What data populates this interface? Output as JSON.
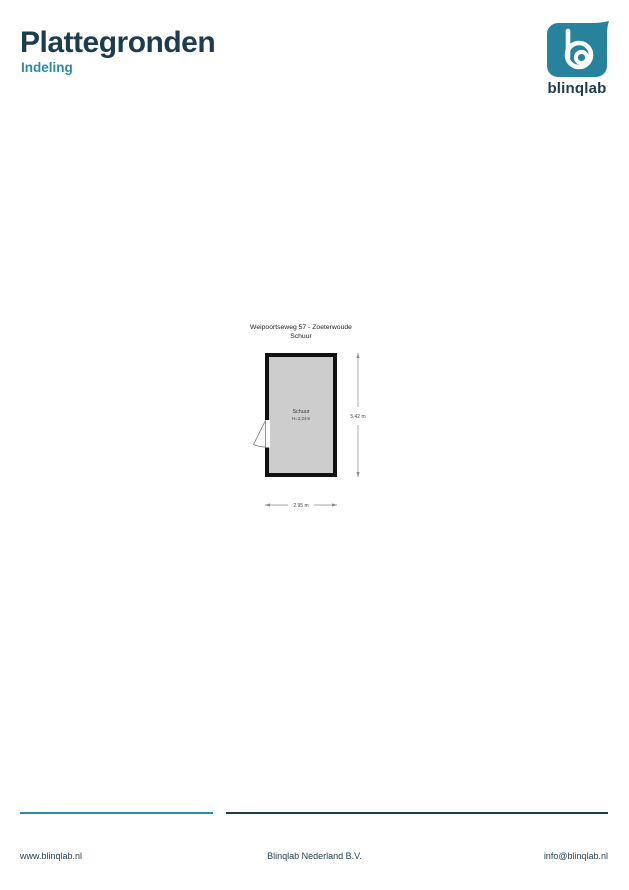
{
  "header": {
    "title": "Plattegronden",
    "subtitle": "Indeling"
  },
  "logo": {
    "wordmark": "blinqlab"
  },
  "colors": {
    "dark_navy": "#1d3c4e",
    "teal": "#2c8ba1",
    "logo_teal": "#27839b",
    "plan_fill": "#cdcdcd",
    "wall": "#111111"
  },
  "floorplan": {
    "title_line1": "Weipoortseweg 57 - Zoeterwoude",
    "title_line2": "Schuur",
    "room": {
      "name": "Schuur",
      "height_label": "H=3,24m"
    },
    "dimensions": {
      "vertical": "5.42 m",
      "horizontal": "2.95 m"
    }
  },
  "footer": {
    "website": "www.blinqlab.nl",
    "company": "Blinqlab Nederland B.V.",
    "email": "info@blinqlab.nl"
  }
}
